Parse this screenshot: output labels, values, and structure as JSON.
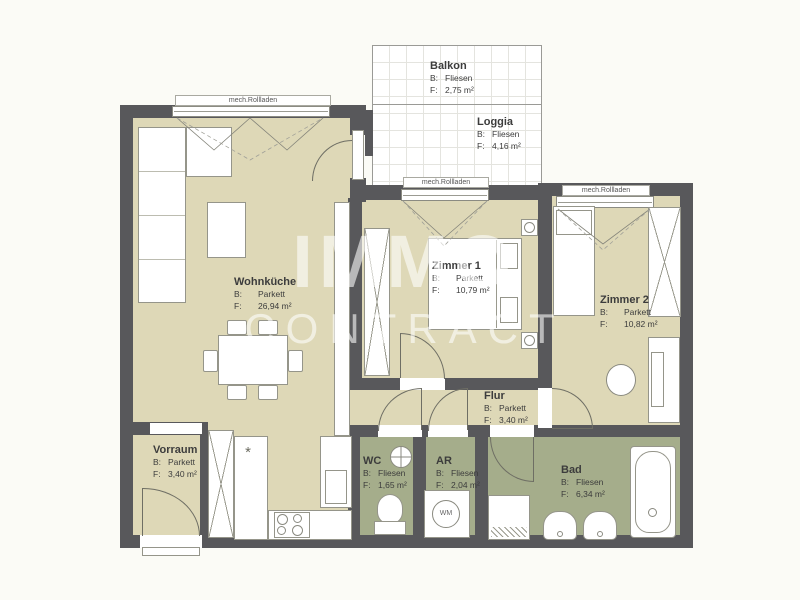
{
  "watermark": {
    "line1": "IMMO",
    "line2": "CONTRACT"
  },
  "shutter_label": "mech.Rollladen",
  "rooms": [
    {
      "name": "Balkon",
      "b_label": "B:",
      "b_value": "Fliesen",
      "f_label": "F:",
      "f_value": "2,75 m²"
    },
    {
      "name": "Loggia",
      "b_label": "B:",
      "b_value": "Fliesen",
      "f_label": "F:",
      "f_value": "4,16 m²"
    },
    {
      "name": "Wohnküche",
      "b_label": "B:",
      "b_value": "Parkett",
      "f_label": "F:",
      "f_value": "26,94 m²"
    },
    {
      "name": "Zimmer 1",
      "b_label": "B:",
      "b_value": "Parkett",
      "f_label": "F:",
      "f_value": "10,79 m²"
    },
    {
      "name": "Zimmer 2",
      "b_label": "B:",
      "b_value": "Parkett",
      "f_label": "F:",
      "f_value": "10,82 m²"
    },
    {
      "name": "Flur",
      "b_label": "B:",
      "b_value": "Parkett",
      "f_label": "F:",
      "f_value": "3,40 m²"
    },
    {
      "name": "Vorraum",
      "b_label": "B:",
      "b_value": "Parkett",
      "f_label": "F:",
      "f_value": "3,40 m²"
    },
    {
      "name": "WC",
      "b_label": "B:",
      "b_value": "Fliesen",
      "f_label": "F:",
      "f_value": "1,65 m²"
    },
    {
      "name": "AR",
      "b_label": "B:",
      "b_value": "Fliesen",
      "f_label": "F:",
      "f_value": "2,04 m²"
    },
    {
      "name": "Bad",
      "b_label": "B:",
      "b_value": "Fliesen",
      "f_label": "F:",
      "f_value": "6,34 m²"
    }
  ],
  "appliances": {
    "washing_machine_label": "WM"
  },
  "icons": {
    "sink_symbol": "*"
  },
  "colors": {
    "background": "#fbfbf6",
    "wall": "#58585b",
    "floor_living": "#ded8b7",
    "floor_wet": "#a5ad8b",
    "watermark_text": "rgba(255,255,255,0.58)"
  }
}
